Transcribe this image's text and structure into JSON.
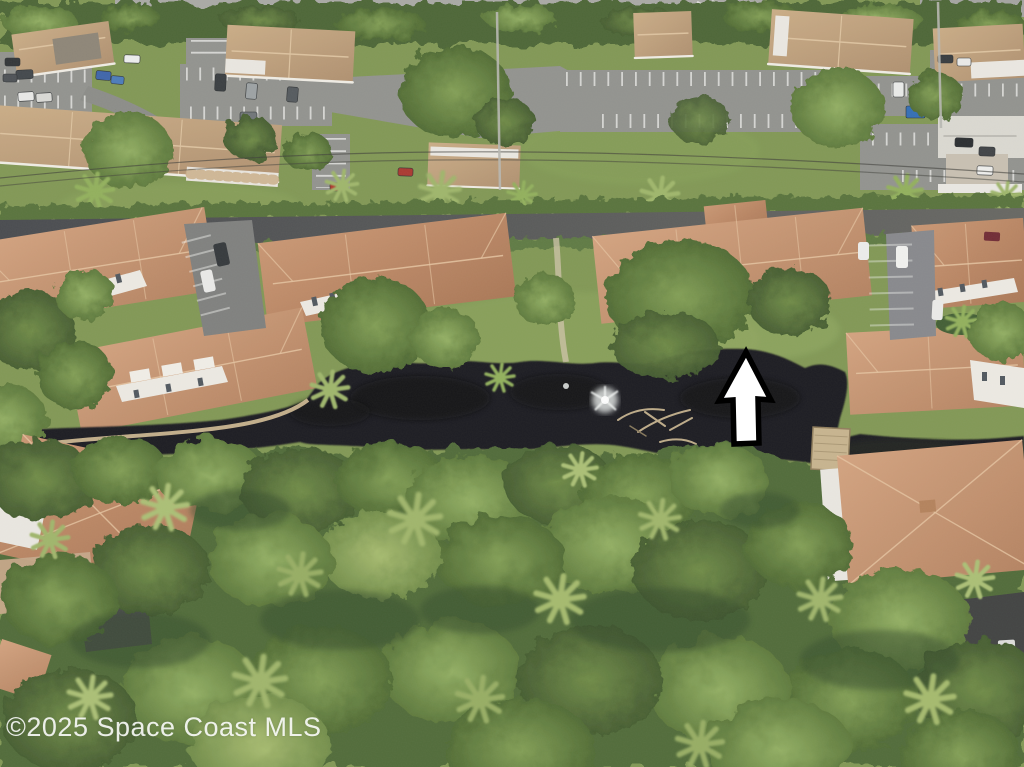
{
  "photo": {
    "kind": "aerial-drone-photo",
    "subject": "Residential condo community with tile-roof townhomes, parking lots, dark pond with fountain, and dense tree canopy"
  },
  "watermark": {
    "text": "©2025 Space Coast MLS",
    "color": "#ffffff"
  },
  "annotation": {
    "shape": "up-arrow",
    "fill": "#ffffff",
    "outline": "#000000"
  },
  "palette": {
    "grass": "#7e9551",
    "canopy": "#4e6834",
    "tree_light": "#90ad5f",
    "tan_roof": "#c0a07c",
    "terracotta_roof": "#c4906e",
    "wall_white": "#ece9e2",
    "asphalt_lot": "#8f908c",
    "road": "#4c4e52",
    "pond_water": "#17191b",
    "seawall_wood": "#c9b48e",
    "fountain_spray": "#e8ecea"
  }
}
